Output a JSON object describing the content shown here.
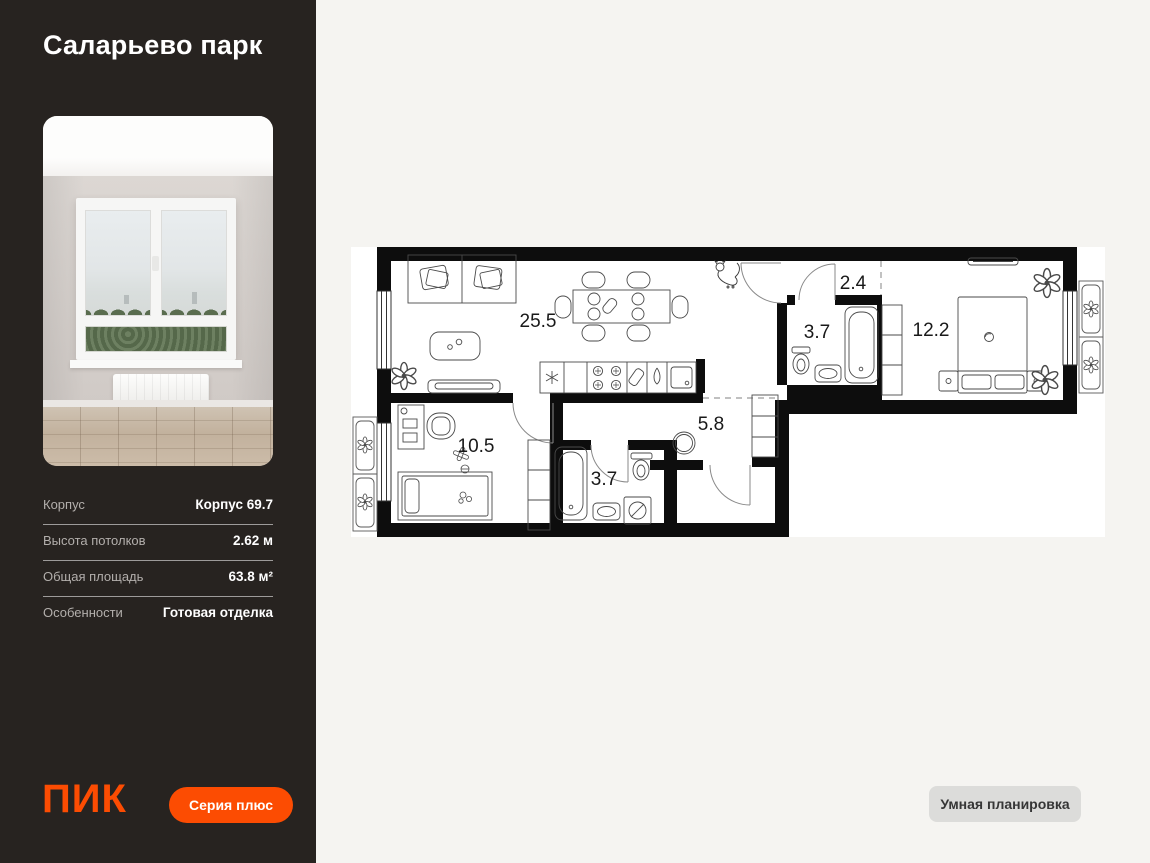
{
  "sidebar": {
    "title": "Саларьево парк",
    "specs": [
      {
        "label": "Корпус",
        "value": "Корпус 69.7"
      },
      {
        "label": "Высота потолков",
        "value": "2.62 м"
      },
      {
        "label": "Общая площадь",
        "value": "63.8 м²"
      },
      {
        "label": "Особенности",
        "value": "Готовая отделка"
      }
    ],
    "logo_text": "ПИК",
    "series_button": "Серия плюс"
  },
  "plan": {
    "rooms": [
      {
        "name": "living-kitchen",
        "area": "25.5"
      },
      {
        "name": "corridor",
        "area": "2.4"
      },
      {
        "name": "bathroom-top",
        "area": "3.7"
      },
      {
        "name": "bedroom",
        "area": "12.2"
      },
      {
        "name": "kids-room",
        "area": "10.5"
      },
      {
        "name": "hallway",
        "area": "5.8"
      },
      {
        "name": "bathroom-bottom",
        "area": "3.7"
      }
    ]
  },
  "actions": {
    "smart_layout_button": "Умная планировка"
  },
  "colors": {
    "accent_orange": "#FC4C02",
    "sidebar_bg": "#272320",
    "page_bg": "#F5F4F1",
    "plan_bg": "#FFFFFF",
    "neutral_button_bg": "#DCDCDA"
  }
}
